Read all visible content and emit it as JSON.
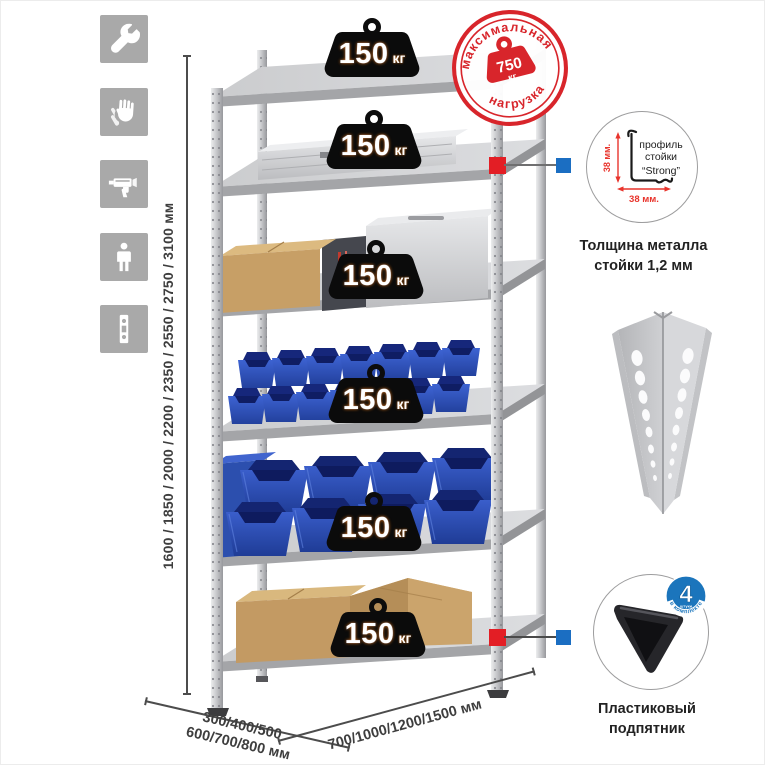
{
  "icon_column": {
    "items": [
      {
        "name": "wrench-icon"
      },
      {
        "name": "gloves-icon"
      },
      {
        "name": "drill-icon"
      },
      {
        "name": "person-icon"
      },
      {
        "name": "rack-profile-icon"
      }
    ]
  },
  "dimensions": {
    "height": "1600 / 1850 / 2000 / 2200 / 2350 / 2550 / 2750 / 3100 мм",
    "depth_line1": "300/400/500",
    "depth_line2": "600/700/800 мм",
    "width": "700/1000/1200/1500 мм"
  },
  "shelf_badges": [
    {
      "value": "150",
      "unit": "кг"
    },
    {
      "value": "150",
      "unit": "кг"
    },
    {
      "value": "150",
      "unit": "кг"
    },
    {
      "value": "150",
      "unit": "кг"
    },
    {
      "value": "150",
      "unit": "кг"
    },
    {
      "value": "150",
      "unit": "кг"
    }
  ],
  "max_load_stamp": {
    "top_text": "максимальная",
    "bottom_text": "нагрузка",
    "value": "750",
    "unit": "кг"
  },
  "profile_detail": {
    "label_line1": "профиль",
    "label_line2": "стойки",
    "label_line3": "“Strong”",
    "vertical_dim": "38 мм.",
    "horizontal_dim": "38 мм.",
    "caption_line1": "Толщина металла",
    "caption_line2": "стойки 1,2 мм"
  },
  "foot_detail": {
    "badge_number": "4",
    "badge_small_text": "штуки",
    "badge_arc_text": "в комплекте",
    "caption_line1": "Пластиковый",
    "caption_line2": "подпятник"
  },
  "colors": {
    "accent_red": "#d8252b",
    "marker_red": "#e31e25",
    "marker_blue": "#1b6ec2",
    "badge_blue": "#1b75bc",
    "bin_blue": "#2b50b5"
  }
}
